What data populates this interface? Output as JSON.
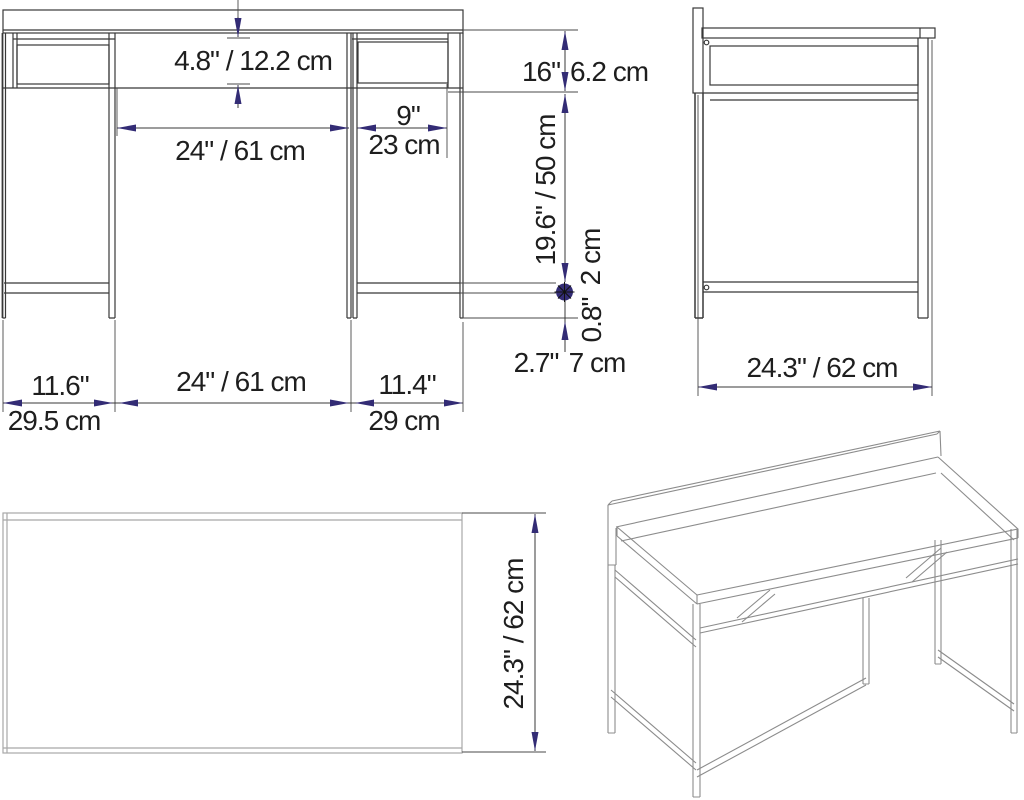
{
  "drawing": {
    "front_view": {
      "shelf_height": "4.8\" / 12.2 cm",
      "desk_opening_width_top": "24\" / 61 cm",
      "side_shelf_width_in": "9\"",
      "side_shelf_width_cm": "23 cm",
      "top_section_height_in": "16\"",
      "top_section_height_cm": "6.2 cm",
      "leg_clearance_height": "19.6\" / 50 cm",
      "stretcher_thickness_cm": "2 cm",
      "stretcher_thickness_in": "0.8\"",
      "foot_height_in": "2.7\"",
      "foot_height_cm": "7 cm",
      "left_section_width_in": "11.6\"",
      "left_section_width_cm": "29.5 cm",
      "desk_opening_width_bottom": "24\" / 61 cm",
      "right_section_width_in": "11.4\"",
      "right_section_width_cm": "29 cm"
    },
    "side_view": {
      "depth": "24.3\" / 62 cm"
    },
    "top_view": {
      "depth": "24.3\" / 62 cm"
    },
    "colors": {
      "dimension_accent": "#332c75",
      "line_dark": "#383838",
      "line_light": "#a8a8a8",
      "perspective_line": "#8c8c8c",
      "text": "#1e1e1e",
      "background": "#ffffff"
    }
  }
}
